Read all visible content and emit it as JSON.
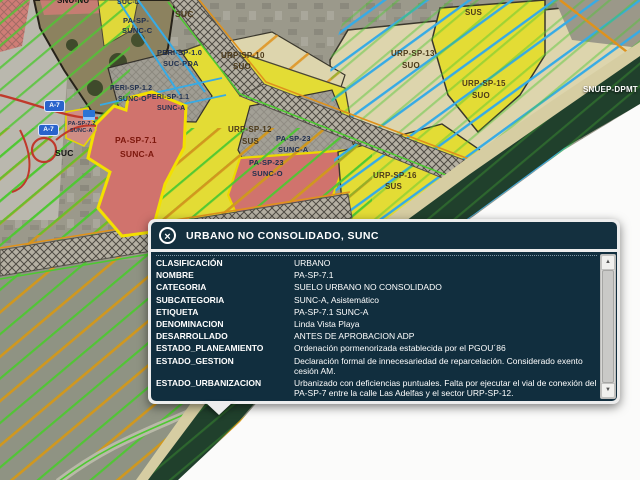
{
  "map": {
    "labels": [
      {
        "text": "SNU-NU"
      },
      {
        "text": "SUC-L"
      },
      {
        "text": "PA-SP-"
      },
      {
        "text": "SUNC-C"
      },
      {
        "text": "SUC"
      },
      {
        "text": "PERI-SP-1.0"
      },
      {
        "text": "SUC-PDA"
      },
      {
        "text": "URP-SP-10"
      },
      {
        "text": "SUO"
      },
      {
        "text": "PERI-SP-1.2"
      },
      {
        "text": "SUNC-O"
      },
      {
        "text": "PERI-SP-1.1"
      },
      {
        "text": "SUNC-A"
      },
      {
        "text": "URP-SP-12"
      },
      {
        "text": "SUS"
      },
      {
        "text": "PA-SP-23"
      },
      {
        "text": "SUNC-A"
      },
      {
        "text": "PA-SP-23"
      },
      {
        "text": "SUNC-O"
      },
      {
        "text": "PA-SP-7.1"
      },
      {
        "text": "SUNC-A"
      },
      {
        "text": "PA-SP-7.2"
      },
      {
        "text": "SUNC-A"
      },
      {
        "text": "SUC"
      },
      {
        "text": "URP-SP-13"
      },
      {
        "text": "SUO"
      },
      {
        "text": "URP-SP-15"
      },
      {
        "text": "SUO"
      },
      {
        "text": "URP-SP-16"
      },
      {
        "text": "SUS"
      },
      {
        "text": "URP-SP-1"
      },
      {
        "text": "SUS"
      },
      {
        "text": "SNUEP-DPMT"
      }
    ],
    "shields": [
      {
        "text": "A-7"
      },
      {
        "text": "A-7"
      }
    ]
  },
  "popup": {
    "title": "URBANO NO CONSOLIDADO, SUNC",
    "close_glyph": "×",
    "scrollbar": {
      "up_glyph": "▲",
      "down_glyph": "▼"
    },
    "rows": [
      {
        "label": "CLASIFICACIÓN",
        "value": "URBANO"
      },
      {
        "label": "NOMBRE",
        "value": "PA-SP-7.1"
      },
      {
        "label": "CATEGORIA",
        "value": "SUELO URBANO NO CONSOLIDADO"
      },
      {
        "label": "SUBCATEGORIA",
        "value": "SUNC-A, Asistemático"
      },
      {
        "label": "ETIQUETA",
        "value": "PA-SP-7.1 SUNC-A"
      },
      {
        "label": "DENOMINACION",
        "value": "Linda Vista Playa"
      },
      {
        "label": "DESARROLLADO",
        "value": "ANTES DE APROBACION ADP"
      },
      {
        "label": "ESTADO_PLANEAMIENTO",
        "value": "Ordenación pormenorizada establecida por el PGOU´86"
      },
      {
        "label": "ESTADO_GESTION",
        "value": "Declaración formal de innecesariedad de reparcelación. Considerado exento cesión AM."
      },
      {
        "label": "ESTADO_URBANIZACION",
        "value": "Urbanizado con deficiencias puntuales. Falta por ejecutar el vial de conexión del PA-SP-7 entre la calle Las Adelfas y el sector URP-SP-12."
      },
      {
        "label": "JUSTIF_RESERVA_EXENCION_VP",
        "value": "ARI con ord. pormenorizada establecida PGOU´86"
      }
    ]
  },
  "colors": {
    "panel_bg": "#112e3e",
    "panel_header_bg": "#14303f",
    "panel_border": "#ededed",
    "zone_yellow": "#e3dc35",
    "zone_red": "#d0736d",
    "zone_beige": "#ddd5ad",
    "line_green": "#4ec832",
    "line_orange": "#df921c",
    "line_blue": "#36abe6"
  }
}
